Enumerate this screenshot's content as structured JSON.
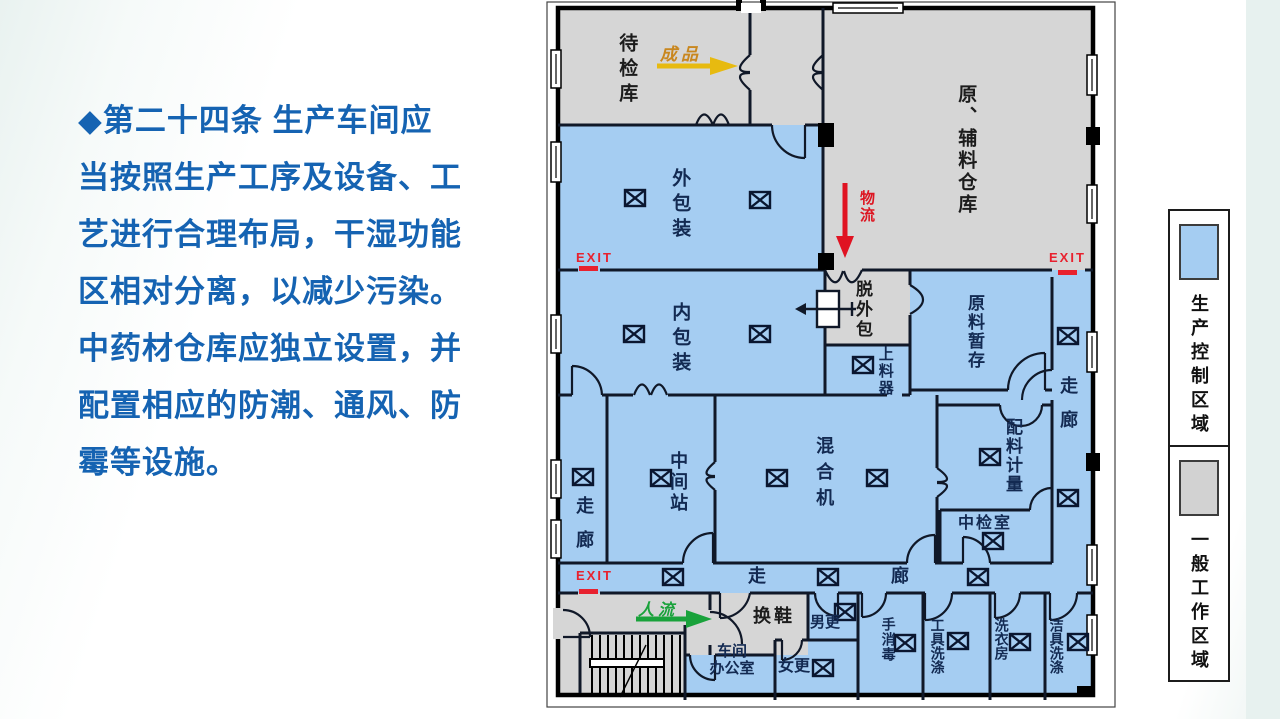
{
  "slide": {
    "paragraph_lines": [
      "◆第二十四条  生产车间应",
      "当按照生产工序及设备、工",
      "艺进行合理布局，干湿功能",
      "区相对分离，以减少污染。",
      "中药材仓库应独立设置，并",
      "配置相应的防潮、通风、防",
      "霉等设施。"
    ],
    "accent_text_color": "#1563B2"
  },
  "plan": {
    "labels": {
      "waiting_store": "待检库",
      "raw_aux_warehouse": "原、辅料仓库",
      "outer_packing": "外包装",
      "inner_packing": "内包装",
      "strip_outer_pack": "脱外包",
      "feeder": "上料器",
      "raw_temp_storage": "原料暂存",
      "batching_metering": "配料计量",
      "corridor_right": "走廊",
      "corridor_left": "走廊",
      "mid_station": "中间站",
      "mixer": "混合机",
      "mid_inspection": "中检室",
      "corridor_bottom_a": "走",
      "corridor_bottom_b": "廊",
      "shoe_change": "换鞋",
      "men_change": "男更",
      "office_line1": "车间",
      "office_line2": "办公室",
      "women_change": "女更",
      "hand_disinfect": "手消毒",
      "tool_washing": "工具洗涤",
      "laundry": "洗衣房",
      "cleaning_tool_wash": "洁具洗涤"
    },
    "flows": {
      "finished_goods": "成品",
      "logistics": "物流",
      "people_flow": "人流"
    },
    "exit_label": "EXIT",
    "colors": {
      "production_area": "#A5CDF2",
      "general_area": "#D6D6D6",
      "exit_red": "#E8212E",
      "finished_arrow": "#E7BA10",
      "logistics_arrow": "#E01322",
      "people_arrow": "#19A23B"
    }
  },
  "legend": {
    "production_label": "生产控制区域",
    "general_label": "一般工作区域",
    "production_color": "#A5CDF2",
    "general_color": "#D6D6D6"
  }
}
